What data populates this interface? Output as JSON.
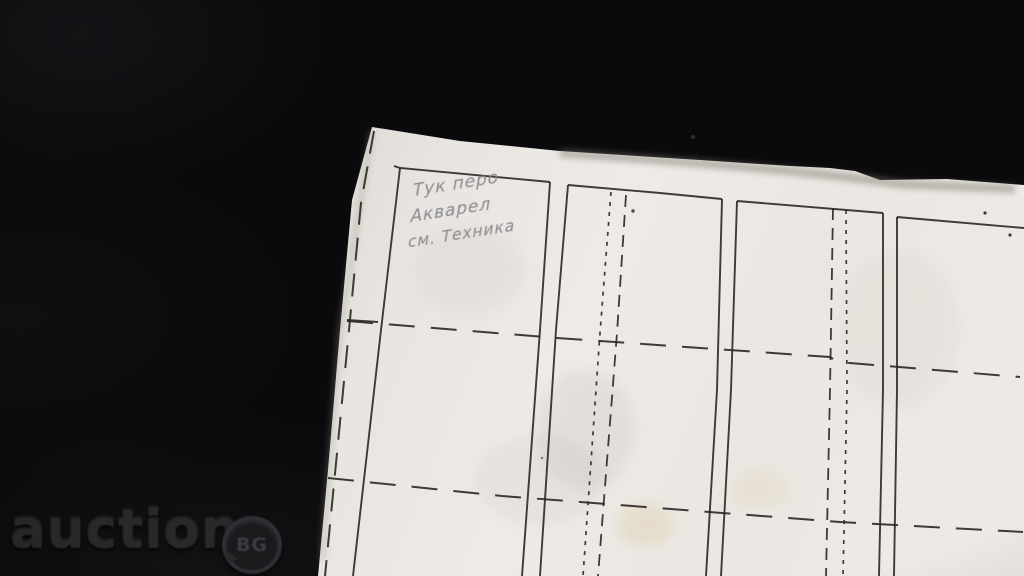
{
  "colors": {
    "background": "#0a0a0c",
    "paper": "#eae7e2",
    "line": "#2e2b27",
    "pencil": "#85848b",
    "watermark": "#29292b"
  },
  "watermark": {
    "brand": "auction",
    "badge": "BG"
  },
  "handwriting": {
    "lines": [
      "Тук перо",
      "Акварел",
      "см. Техника"
    ]
  },
  "paper_outline": "372,127 460,141 560,151 700,160 790,166 830,168 855,171 880,180 947,179 1024,185 1024,576 318,576 328,470 340,330 352,200",
  "grid": {
    "stroke": "#2e2b27",
    "groups": [
      {
        "name": "solid-border",
        "dash": "",
        "width": 1.9,
        "lines": [
          [
            394,
            166,
            400,
            168,
            550,
            182
          ],
          [
            400,
            168,
            381,
            330,
            353,
            576
          ],
          [
            550,
            182,
            540,
            330,
            522,
            576
          ],
          [
            568,
            185,
            660,
            193,
            722,
            199
          ],
          [
            568,
            185,
            556,
            330,
            540,
            576
          ],
          [
            722,
            199,
            717,
            390,
            706,
            576
          ],
          [
            737,
            201,
            883,
            213
          ],
          [
            737,
            201,
            731,
            390,
            721,
            576
          ],
          [
            883,
            213,
            883,
            390,
            879,
            576
          ],
          [
            897,
            217,
            1024,
            228
          ],
          [
            897,
            217,
            897,
            390,
            894,
            576
          ],
          [
            347,
            320,
            378,
            322
          ]
        ]
      },
      {
        "name": "margin-cut-dash",
        "dash": "23 13",
        "width": 2,
        "lines": [
          [
            374,
            131,
            361,
            203,
            349,
            330,
            337,
            453,
            325,
            576
          ]
        ]
      },
      {
        "name": "row-separator-dash",
        "dash": "26 16",
        "width": 2,
        "lines": [
          [
            347,
            321,
            557,
            338,
            830,
            357,
            838,
            362,
            1020,
            377
          ],
          [
            328,
            478,
            502,
            496,
            645,
            507,
            840,
            522,
            1023,
            532
          ]
        ]
      },
      {
        "name": "fold-long-dash",
        "dash": "12 8",
        "width": 1.8,
        "lines": [
          [
            626,
            195,
            617,
            333,
            598,
            576
          ],
          [
            833,
            208,
            830,
            390,
            826,
            576
          ]
        ]
      },
      {
        "name": "fold-dotted",
        "dash": "4 6",
        "width": 1.7,
        "lines": [
          [
            611,
            192,
            600,
            333,
            583,
            576
          ],
          [
            846,
            210,
            847,
            390,
            843,
            576
          ]
        ]
      }
    ]
  }
}
